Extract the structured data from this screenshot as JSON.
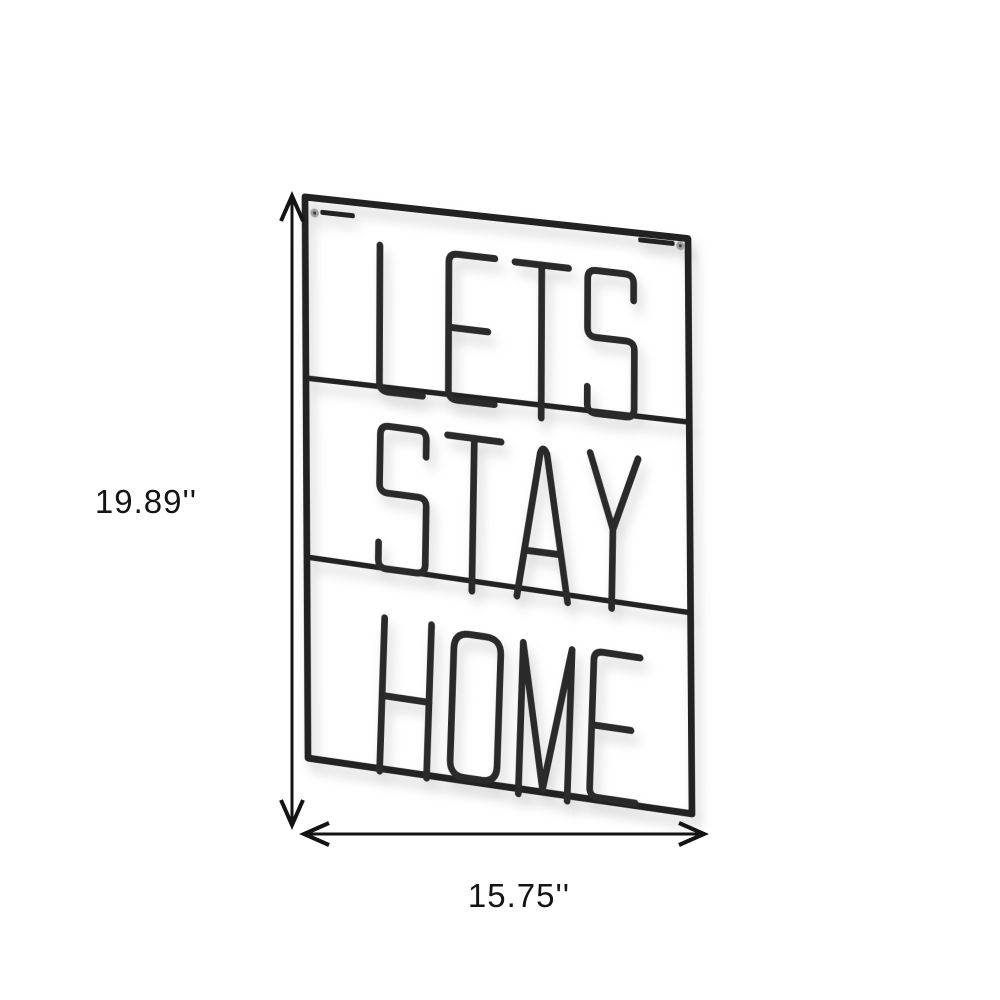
{
  "figure": {
    "type": "product-dimension-diagram",
    "background_color": "#ffffff",
    "sign": {
      "words": [
        "LETS",
        "STAY",
        "HOME"
      ],
      "wire_color": "#2b2b2b",
      "frame_color": "#232323",
      "screw_color": "#a0a0a0",
      "screw_center_color": "#3a3a3a"
    },
    "dimensions": {
      "height_label": "19.89''",
      "width_label": "15.75''",
      "line_color": "#141414"
    }
  }
}
